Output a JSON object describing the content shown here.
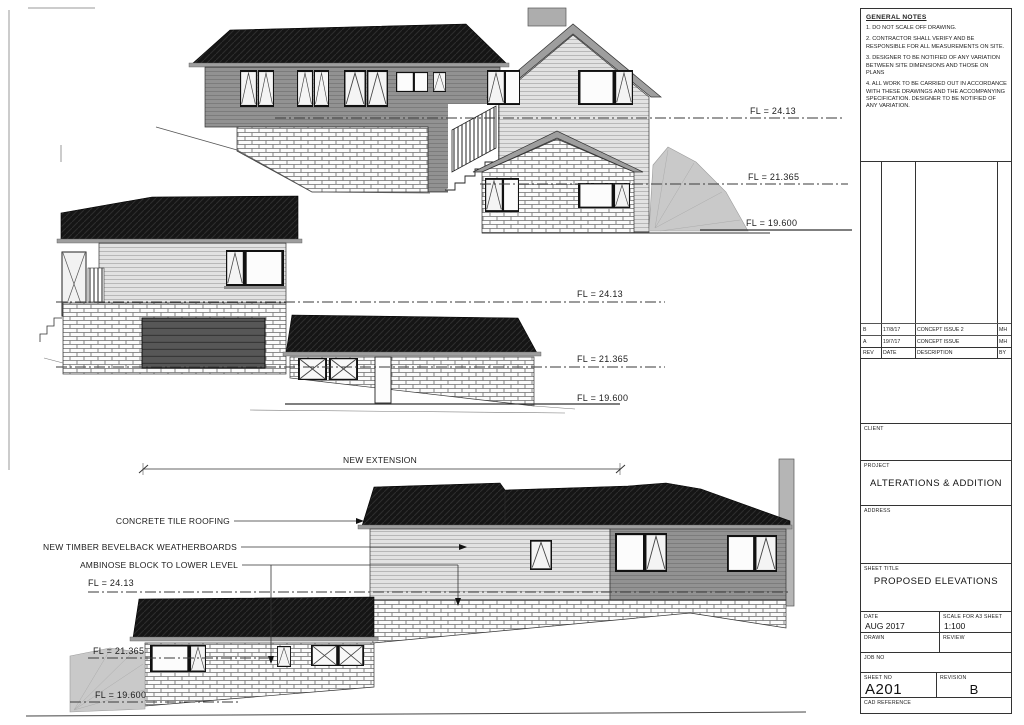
{
  "title_block": {
    "general_notes": {
      "title": "GENERAL NOTES",
      "items": [
        "1. DO NOT SCALE OFF DRAWING.",
        "2. CONTRACTOR SHALL VERIFY AND BE RESPONSIBLE FOR ALL MEASUREMENTS ON SITE.",
        "3. DESIGNER TO BE NOTIFIED OF ANY VARIATION BETWEEN SITE DIMENSIONS AND THOSE ON PLANS",
        "4. ALL WORK TO BE CARRIED OUT IN ACCORDANCE WITH THESE DRAWINGS AND THE ACCOMPANYING SPECIFICATION. DESIGNER TO BE NOTIFIED OF ANY VARIATION."
      ]
    },
    "revision_table": {
      "headers": {
        "rev": "REV",
        "date": "DATE",
        "description": "DESCRIPTION",
        "by": "BY"
      },
      "rows": [
        {
          "rev": "B",
          "date": "17/8/17",
          "description": "CONCEPT ISSUE 2",
          "by": "MH"
        },
        {
          "rev": "A",
          "date": "19/7/17",
          "description": "CONCEPT ISSUE",
          "by": "MH"
        }
      ]
    },
    "client": {
      "label": "CLIENT",
      "value": ""
    },
    "project": {
      "label": "PROJECT",
      "value": "ALTERATIONS & ADDITION"
    },
    "address": {
      "label": "ADDRESS",
      "value": ""
    },
    "sheet_title": {
      "label": "SHEET TITLE",
      "value": "PROPOSED ELEVATIONS"
    },
    "date": {
      "label": "DATE",
      "value": "AUG 2017"
    },
    "scale": {
      "label": "SCALE FOR A3 SHEET",
      "value": "1:100"
    },
    "drawn": {
      "label": "DRAWN",
      "value": ""
    },
    "review": {
      "label": "REVIEW",
      "value": ""
    },
    "job_no": {
      "label": "JOB NO",
      "value": ""
    },
    "sheet_no": {
      "label": "SHEET NO",
      "value": "A201"
    },
    "revision": {
      "label": "REVISION",
      "value": "B"
    },
    "cad_reference": {
      "label": "CAD REFERENCE",
      "value": ""
    }
  },
  "drawing": {
    "levels": {
      "fl_top": "FL = 24.13",
      "fl_mid": "FL = 21.365",
      "fl_low": "FL = 19.600"
    },
    "annotations": {
      "new_extension": "NEW EXTENSION",
      "roofing": "CONCRETE TILE ROOFING",
      "weatherboards": "NEW TIMBER BEVELBACK WEATHERBOARDS",
      "block": "AMBINOSE BLOCK TO LOWER LEVEL"
    }
  }
}
